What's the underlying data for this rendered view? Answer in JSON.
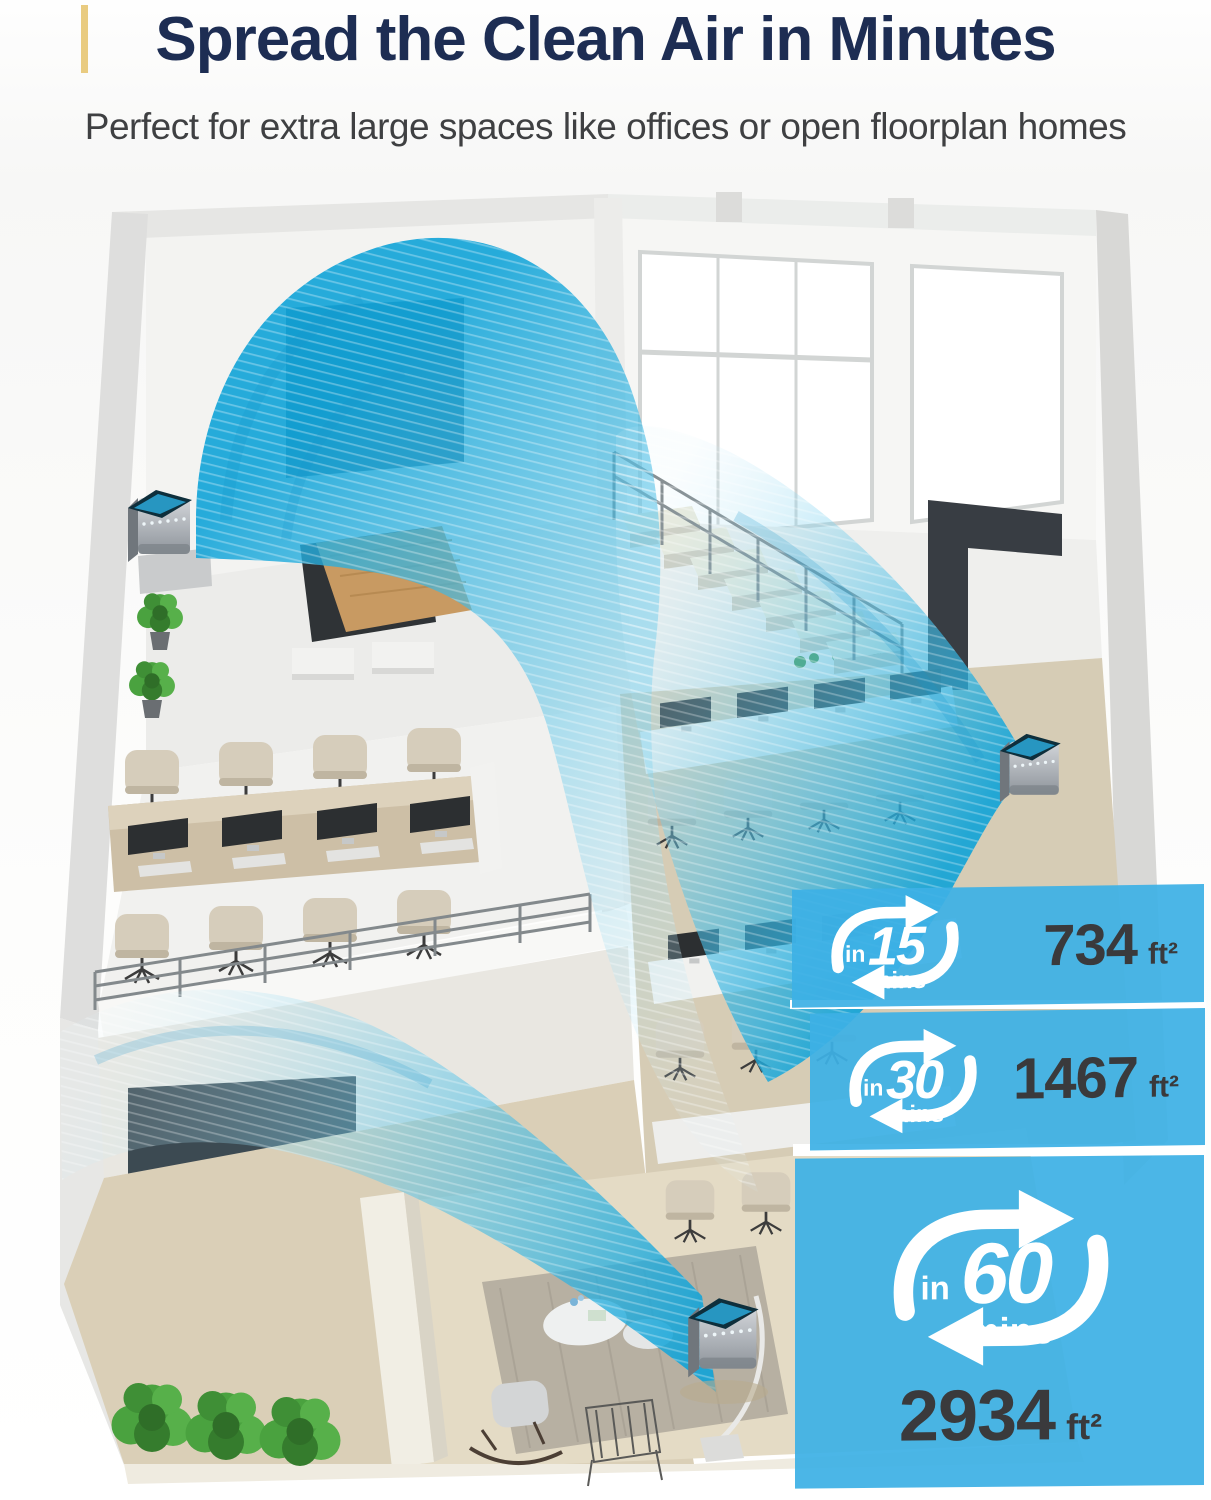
{
  "header": {
    "title": "Spread the Clean Air in Minutes",
    "subtitle": "Perfect for extra large spaces like offices or open floorplan homes",
    "accent_color": "#e9cb80",
    "title_color": "#1d2d53"
  },
  "illustration": {
    "name": "isometric-cutaway-of-offices-with-air-purifiers",
    "airflow_color": "#2fb3e4",
    "purifier_count": 3
  },
  "panels": {
    "background_color": "#3db0e5",
    "value_color": "#3a3a3c",
    "icon": "cycle-arrows-icon",
    "stats": [
      {
        "prefix": "in",
        "time": "15",
        "unit": "mins",
        "area": "734",
        "area_unit": "ft²"
      },
      {
        "prefix": "in",
        "time": "30",
        "unit": "mins",
        "area": "1467",
        "area_unit": "ft²"
      },
      {
        "prefix": "in",
        "time": "60",
        "unit": "mins",
        "area": "2934",
        "area_unit": "ft²"
      }
    ]
  }
}
